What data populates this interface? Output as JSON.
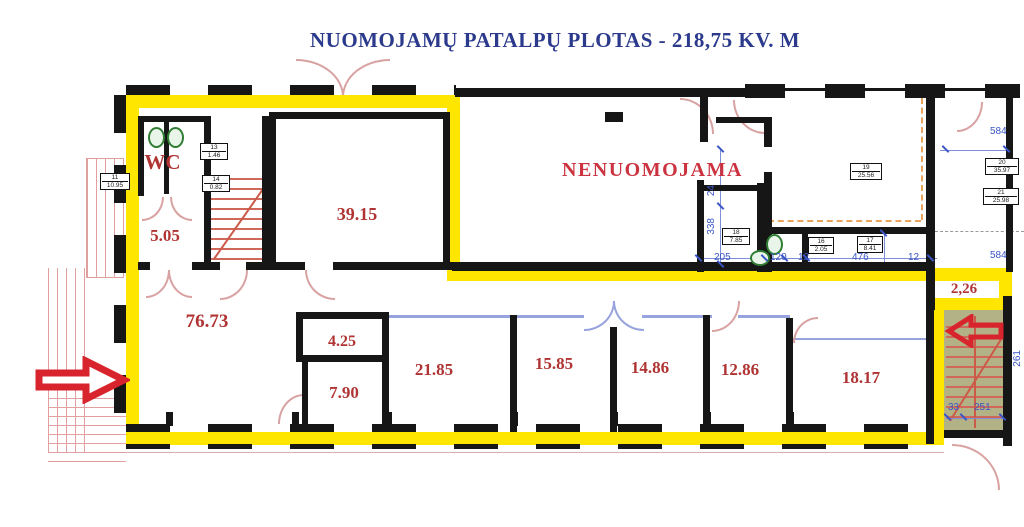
{
  "title": "NUOMOJAMŲ PATALPŲ PLOTAS - 218,75 KV. M",
  "zone": {
    "not_rentable": "NENUOMOJAMA",
    "wc": "WC"
  },
  "rooms": [
    {
      "area": "5.05"
    },
    {
      "area": "39.15"
    },
    {
      "area": "76.73"
    },
    {
      "area": "4.25"
    },
    {
      "area": "7.90"
    },
    {
      "area": "21.85"
    },
    {
      "area": "15.85"
    },
    {
      "area": "14.86"
    },
    {
      "area": "12.86"
    },
    {
      "area": "18.17"
    },
    {
      "area": "2,26"
    }
  ],
  "tags": [
    {
      "num": "13",
      "area": "1.46"
    },
    {
      "num": "14",
      "area": "0.82"
    },
    {
      "num": "11",
      "area": "10.95"
    },
    {
      "num": "19",
      "area": "25.56"
    },
    {
      "num": "18",
      "area": "7.85"
    },
    {
      "num": "16",
      "area": "2.05"
    },
    {
      "num": "17",
      "area": "8.41"
    },
    {
      "num": "20",
      "area": "35.97"
    },
    {
      "num": "21",
      "area": "25.98"
    }
  ],
  "dims": {
    "t584a": "584",
    "t584b": "584",
    "d205": "205",
    "d120": "120",
    "d12a": "12",
    "d476": "476",
    "d12b": "12",
    "d171": "171",
    "d24": "24",
    "d338": "338",
    "d33": "33",
    "d251": "251",
    "d261": "261"
  },
  "colors": {
    "highlight": "#ffe600",
    "room_label": "#b03434",
    "zone_label": "#cc3340",
    "title": "#2b3a8c",
    "dimension": "#3a55c8",
    "stairwell_fill": "#b2b286",
    "arrow": "#d8242c"
  }
}
